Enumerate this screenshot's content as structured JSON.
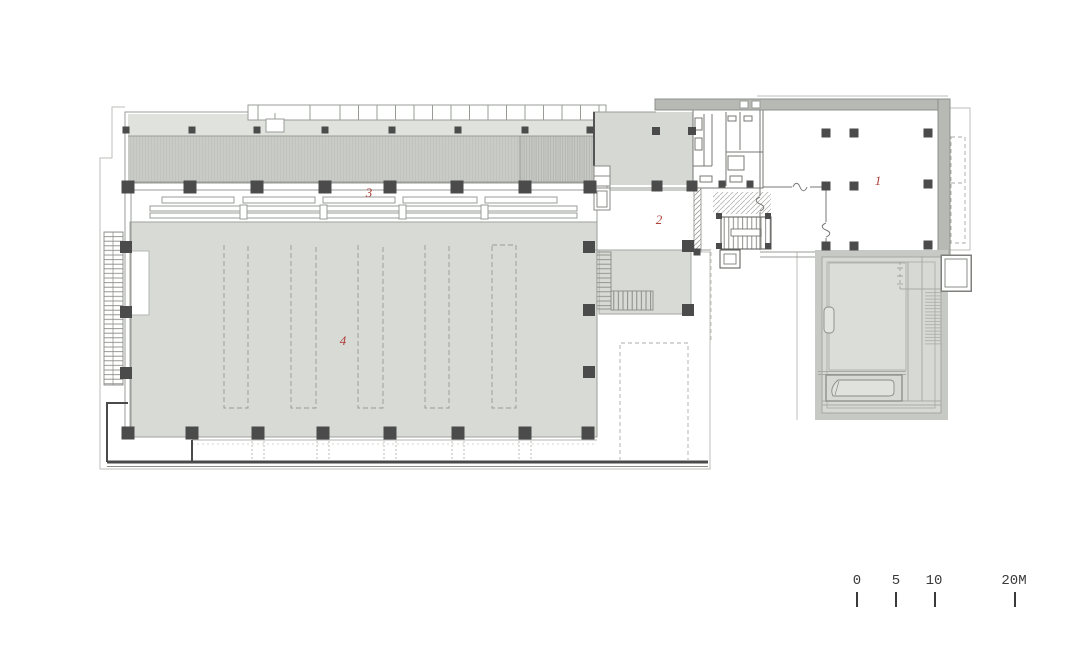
{
  "plan": {
    "type": "architectural-floor-plan",
    "room_labels": [
      {
        "number": "1"
      },
      {
        "number": "2"
      },
      {
        "number": "3"
      },
      {
        "number": "4"
      }
    ],
    "scale_bar": {
      "ticks": [
        "0",
        "5",
        "10",
        "20M"
      ]
    },
    "colors": {
      "label": "#ae3e37",
      "scale_text": "#3a3a3a",
      "hall_fill": "#d8dad6",
      "band_dark": "#c9cbc7",
      "band_light": "#e0e2de",
      "wall_thick": "#b7b9b5",
      "courtyard_fill": "#d7d9d5",
      "column": "#4b4b4b",
      "line": "#8a8c88"
    }
  }
}
